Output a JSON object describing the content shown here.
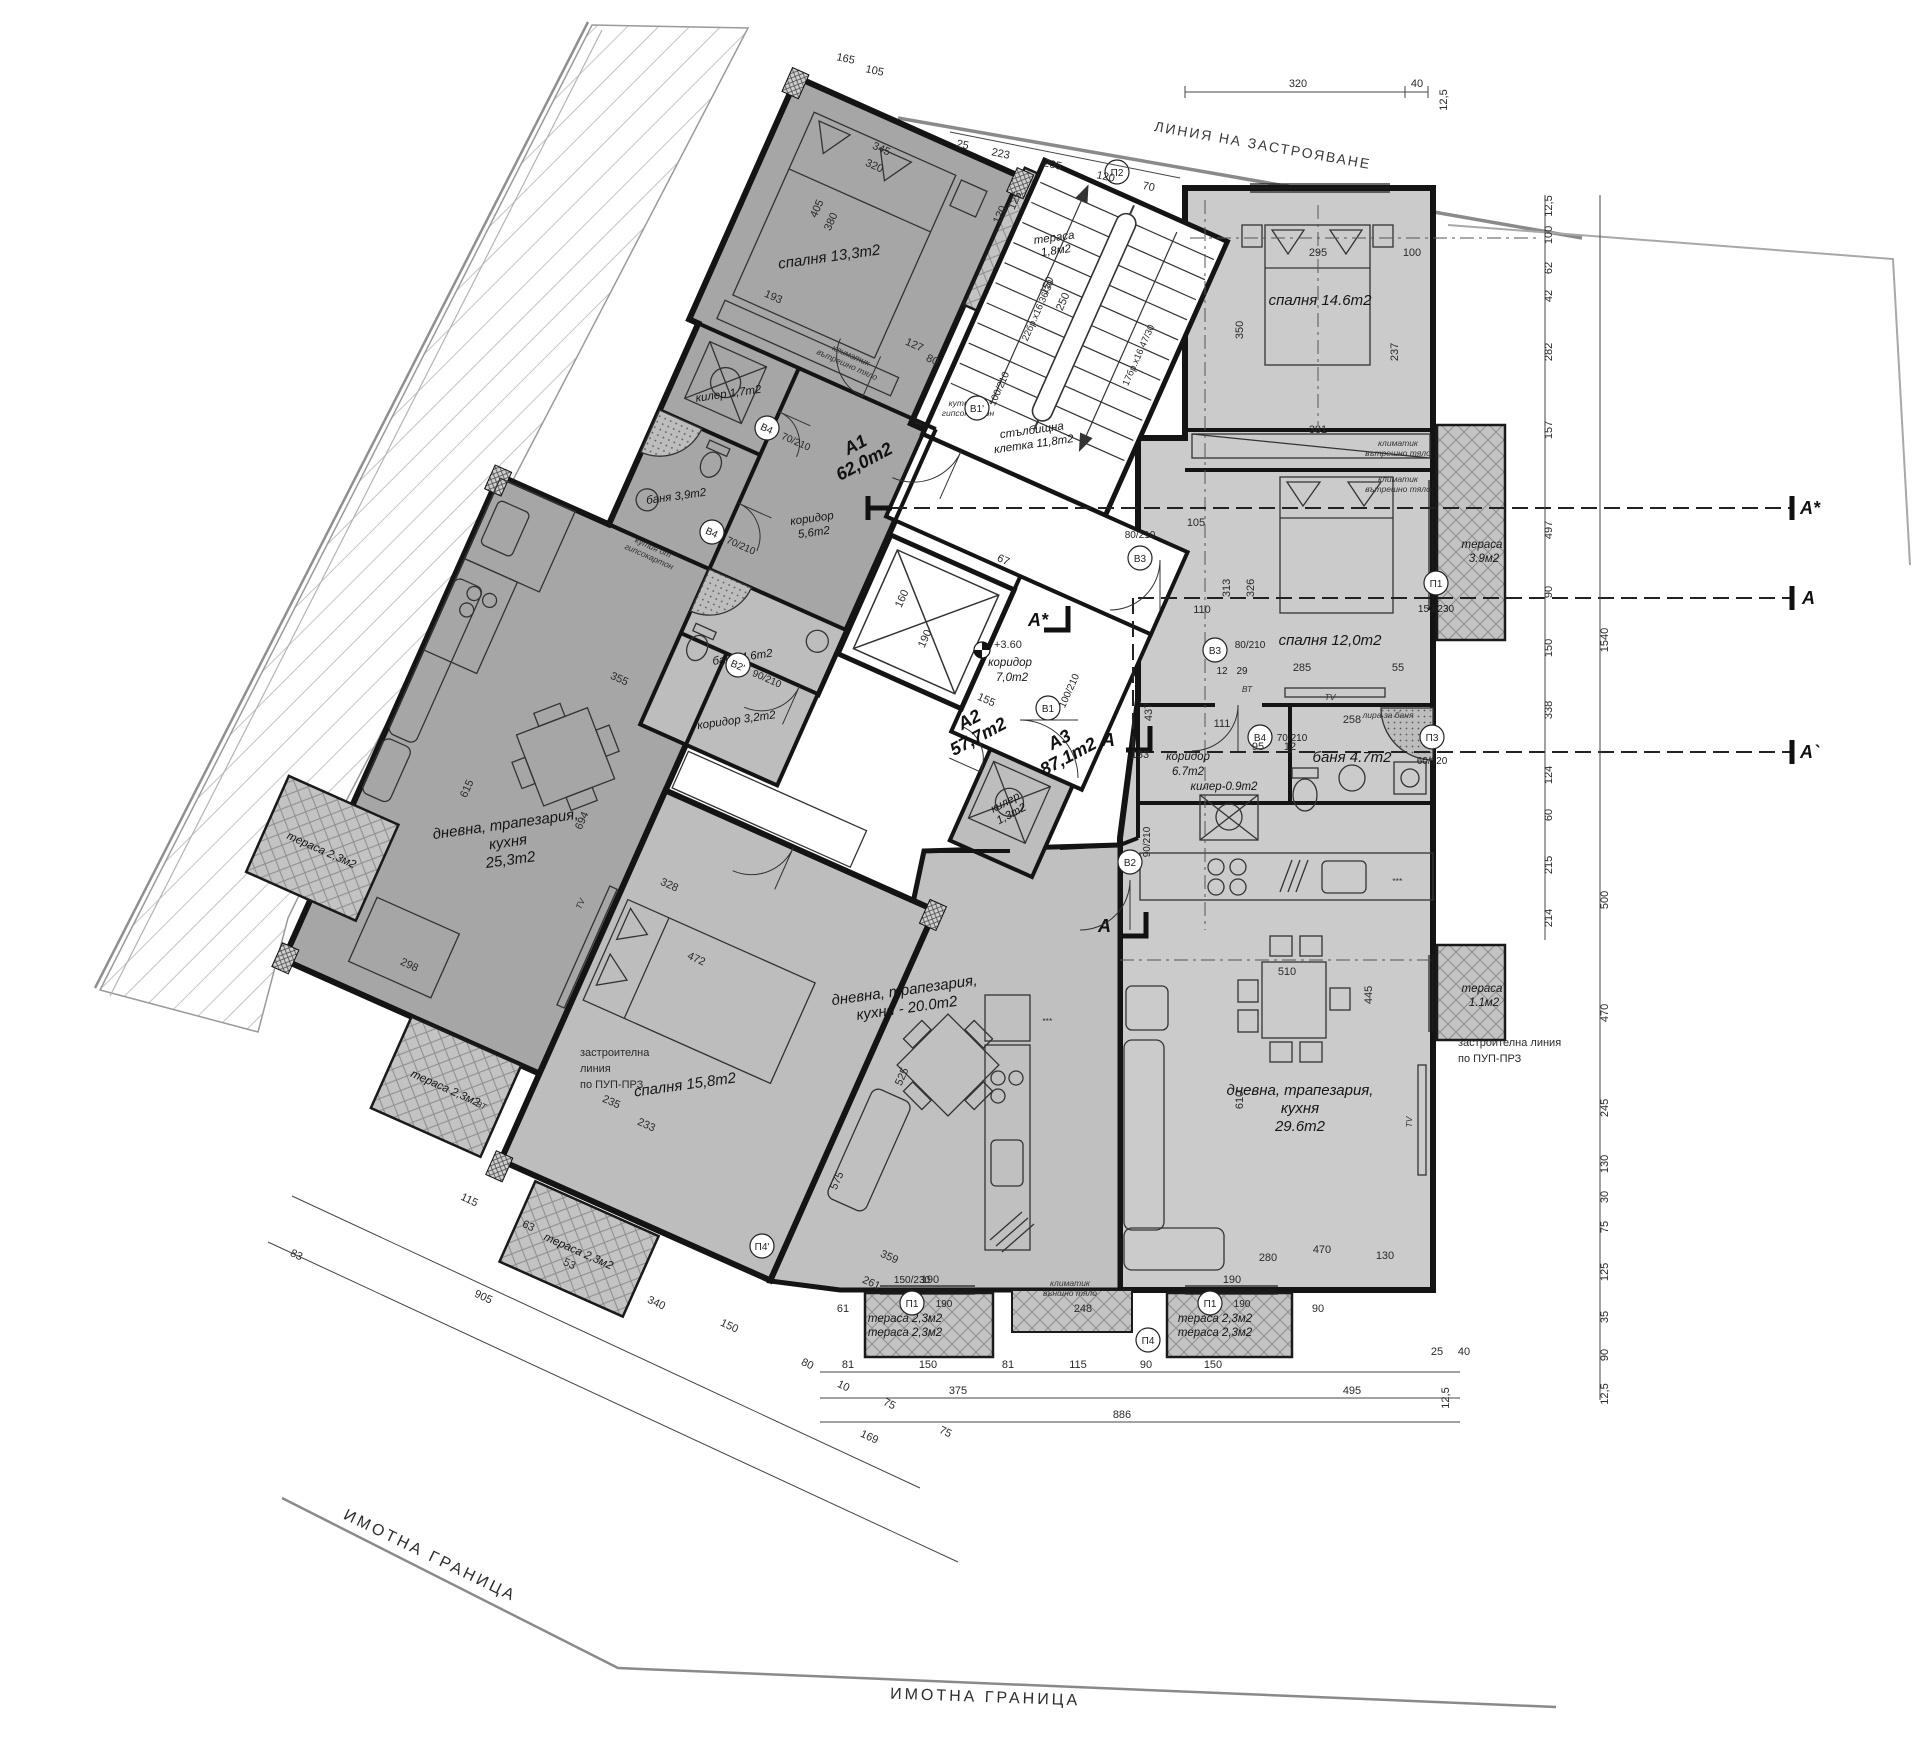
{
  "boundary": {
    "property": "ИМОТНА ГРАНИЦА",
    "building_line": "ЛИНИЯ НА ЗАСТРОЯВАНЕ",
    "dev1_l1": "застроителна",
    "dev1_l2": "линия",
    "dev1_l3": "по ПУП-ПРЗ",
    "dev2_l1": "застроителна линия",
    "dev2_l2": "по ПУП-ПРЗ"
  },
  "apartments": {
    "a1_id": "А1",
    "a1_area": "62,0m2",
    "a2_id": "А2",
    "a2_area": "57,7m2",
    "a3_id": "А3",
    "a3_area": "87,1m2"
  },
  "rooms": {
    "a1_bedroom": "спалня 13,3m2",
    "a1_terrace_l1": "тераса",
    "a1_terrace_l2": "1,8м2",
    "a1_closet": "килер 1,7m2",
    "a1_bath": "баня 3,9m2",
    "a1_hall_l1": "коридор",
    "a1_hall_l2": "5,6m2",
    "a1_living_l1": "дневна, трапезария,",
    "a1_living_l2": "кухня",
    "a1_living_l3": "25,3m2",
    "a1_terrace2": "тераса 2,3м2",
    "a2_bath": "баня 4,6m2",
    "a2_hall": "коридор 3,2m2",
    "a2_closet_l1": "килер",
    "a2_closet_l2": "1,3m2",
    "a2_bedroom": "спалня 15,8m2",
    "a2_living_l1": "дневна, трапезария,",
    "a2_living_l2": "кухня - 20.0m2",
    "a2_terrace": "тераса 2,3м2",
    "a2_terrace_side": "тераса 2,3м2",
    "a3_bedroom1": "спалня 14.6m2",
    "a3_bedroom2": "спалня 12,0m2",
    "a3_bath": "баня 4.7m2",
    "a3_closet": "килер-0.9m2",
    "a3_hall_l1": "коридор",
    "a3_hall_l2": "6.7m2",
    "a3_living_l1": "дневна, трапезария,",
    "a3_living_l2": "кухня",
    "a3_living_l3": "29.6m2",
    "a3_terrace1_l1": "тераса",
    "a3_terrace1_l2": "3.9м2",
    "a3_terrace2_l1": "тераса",
    "a3_terrace2_l2": "1.1м2",
    "a3_terrace3": "тераса 2,3м2",
    "a3_terrace4": "тераса 2,3м2"
  },
  "common": {
    "stair_l1": "стълбищна",
    "stair_l2": "клетка 11,8m2",
    "hall_l1": "коридор",
    "hall_l2": "7,0m2",
    "level": "+3.60"
  },
  "stairs": {
    "flight1": "22бр.х16,36/30",
    "flight2": "17бр.х16,47/30"
  },
  "annotations": {
    "ac_l1": "климатик",
    "ac_l2": "вътрешно тяло",
    "ac_out_l1": "климатик",
    "ac_out_l2": "външно тяло",
    "drywall_l1": "кутия от",
    "drywall_l2": "гипсокартон",
    "towel": "лира за баня",
    "tv": "TV",
    "vt": "ВТ",
    "fridge": "***"
  },
  "sections": {
    "a_star": "А*",
    "a": "А",
    "a_prime": "А`"
  },
  "tags": {
    "v1p": "В1'",
    "v1": "В1",
    "v2": "В2",
    "v2p": "В2'",
    "v3": "В3",
    "v4": "В4",
    "p1": "П1",
    "p2": "П2",
    "p3": "П3",
    "p4": "П4",
    "p4p": "П4'",
    "s100": "100/210",
    "s90": "90/210",
    "s80": "80/210",
    "s70": "70/210",
    "s150": "150/230",
    "s60": "60/120",
    "s190": "190",
    "s12": "12",
    "s29": "29"
  },
  "dims": {
    "top": [
      "320",
      "40",
      "12,5"
    ],
    "stair_top": [
      "25",
      "223",
      "205",
      "120",
      "70"
    ],
    "right_inner": [
      "12,5",
      "100",
      "62",
      "42",
      "282",
      "157",
      "497",
      "90",
      "150",
      "338",
      "124",
      "60",
      "215",
      "214"
    ],
    "right_outer": [
      "1540",
      "500",
      "470",
      "245",
      "130",
      "30",
      "75",
      "125",
      "35",
      "90",
      "12,5"
    ],
    "bottom_r1": [
      "61",
      "190",
      "248",
      "190",
      "90"
    ],
    "bottom_r2": [
      "81",
      "150",
      "81",
      "115",
      "90",
      "150",
      "25",
      "40"
    ],
    "bottom_r3": [
      "375",
      "886",
      "495",
      "12,5"
    ],
    "left_diag": [
      "83",
      "115",
      "63",
      "905",
      "53",
      "340",
      "150",
      "80",
      "10",
      "75",
      "169",
      "75"
    ],
    "a1": [
      "345",
      "320",
      "405",
      "380",
      "193",
      "127",
      "80",
      "355",
      "615",
      "694",
      "298"
    ],
    "a2": [
      "472",
      "328",
      "233",
      "235",
      "525",
      "359",
      "261",
      "575"
    ],
    "a3": [
      "295",
      "350",
      "237",
      "381",
      "285",
      "55",
      "313",
      "326",
      "437",
      "111",
      "258",
      "110",
      "105",
      "510",
      "445",
      "610",
      "280",
      "470",
      "130",
      "133",
      "95",
      "12",
      "100"
    ],
    "core": [
      "160",
      "190",
      "150",
      "250",
      "125",
      "120",
      "67",
      "155",
      "165",
      "105"
    ]
  }
}
